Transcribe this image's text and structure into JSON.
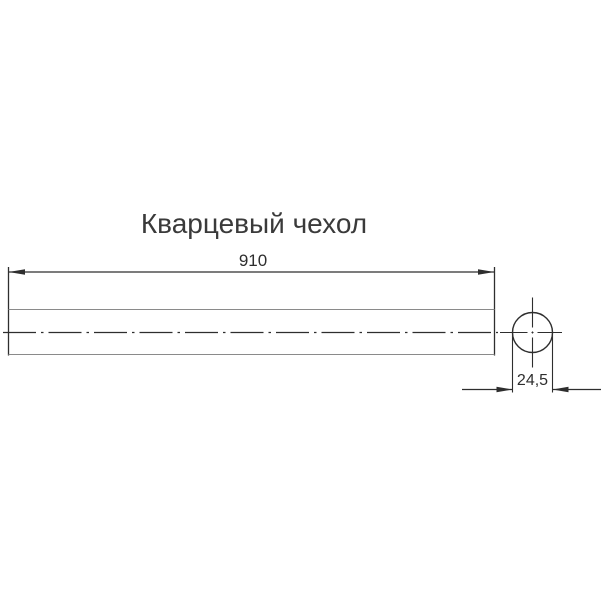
{
  "drawing": {
    "title": "Кварцевый чехол",
    "views": {
      "side_view": {
        "part": "quartz-sleeve-tube",
        "length_dimension": {
          "value": "910"
        }
      },
      "end_view": {
        "part": "quartz-sleeve-end-circle",
        "diameter_dimension": {
          "value": "24,5"
        }
      }
    },
    "colors": {
      "background": "#ffffff",
      "dimension_line": "#2e2e2e",
      "outline_line": "#8a8a8a",
      "text": "#3a3a3a"
    }
  }
}
